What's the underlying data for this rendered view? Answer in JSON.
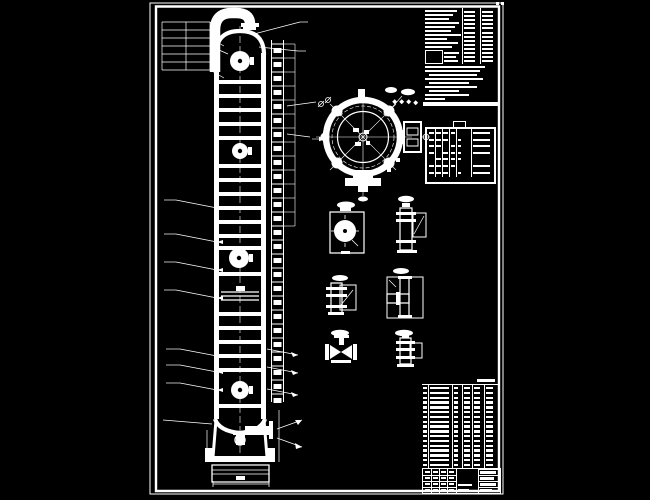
{
  "app": {
    "background": "#000000",
    "ink": "#ffffff",
    "sheet_visible_text_legible": false
  },
  "tower_elevation": {
    "tray_band_ys": [
      80,
      94,
      108,
      122,
      136,
      164,
      178,
      192,
      206,
      220,
      234,
      246,
      272,
      312,
      326,
      340,
      354,
      368,
      404
    ],
    "tray_x": 219,
    "tray_w": 42,
    "tray_h": 4,
    "manholes": [
      [
        240,
        61,
        10
      ],
      [
        240,
        151,
        8
      ],
      [
        239,
        258,
        10
      ],
      [
        240,
        390,
        9
      ]
    ],
    "feed_line_ys": [
      292,
      296,
      300
    ],
    "ladder": {
      "x1": 271.5,
      "x2": 283.5,
      "y0": 44,
      "y1": 398,
      "pitch": 14
    },
    "dim_ties": {
      "x0": 284,
      "x1": 295,
      "y0": 44,
      "y1": 226,
      "pitch": 14
    }
  },
  "dimension_leaders": {
    "top_left_stack_ys": [
      22,
      30,
      38,
      46,
      54,
      62,
      70
    ],
    "top_left_stack_x": [
      162,
      210
    ],
    "mid_left_ys": [
      208,
      242,
      270,
      298
    ],
    "low_left_ys": [
      356,
      372,
      390
    ],
    "right_lower_ys": [
      349,
      367,
      389
    ]
  },
  "tech_notes_panel": {
    "x": 423,
    "y": 8,
    "w": 74,
    "h": 94,
    "upper_lines": [
      [
        2,
        2,
        32
      ],
      [
        2,
        6,
        28
      ],
      [
        2,
        10,
        24
      ],
      [
        2,
        14,
        34
      ],
      [
        2,
        18,
        30
      ],
      [
        2,
        22,
        26
      ],
      [
        2,
        26,
        36
      ],
      [
        2,
        30,
        22
      ],
      [
        2,
        34,
        33
      ],
      [
        2,
        38,
        27
      ]
    ],
    "box": [
      2,
      42,
      16,
      12
    ],
    "box_side_lines": [
      [
        21,
        44,
        15
      ],
      [
        21,
        48,
        12
      ],
      [
        21,
        52,
        14
      ]
    ],
    "table": {
      "rows": 13,
      "col_x": [
        41,
        59
      ],
      "bar_w": 11,
      "row_h": 4.1,
      "y0": 3,
      "divider_x": [
        38.5,
        56.5
      ],
      "divider_h": 56
    },
    "note_lines": [
      [
        2,
        58,
        60
      ],
      [
        2,
        62,
        55
      ],
      [
        6,
        66,
        48
      ],
      [
        2,
        70,
        58
      ],
      [
        6,
        74,
        40
      ],
      [
        2,
        78,
        52
      ],
      [
        6,
        82,
        30
      ],
      [
        2,
        86,
        44
      ],
      [
        2,
        90,
        20
      ]
    ],
    "bottom_band": [
      0,
      93.5,
      77,
      4
    ]
  },
  "nozzle_table": {
    "x": 425,
    "y": 127,
    "w": 67,
    "h": 53,
    "tab": [
      26,
      -6,
      11,
      6
    ],
    "rows": 7,
    "row_h": 6.6,
    "y0": 3,
    "dash_cols": [
      [
        2,
        5
      ],
      [
        9,
        5
      ],
      [
        16,
        5
      ],
      [
        24,
        4
      ],
      [
        31,
        3
      ],
      [
        46,
        17
      ]
    ],
    "divider_x": [
      7.5,
      14.5,
      22,
      29,
      44
    ]
  },
  "parts_list": {
    "x": 422,
    "y": 384,
    "w": 76,
    "h": 84,
    "rows": 17,
    "row_h": 4.8,
    "y0": 2,
    "dash_cols": [
      [
        1,
        4
      ],
      [
        8,
        20
      ],
      [
        32,
        6
      ],
      [
        42,
        6
      ],
      [
        52,
        7
      ],
      [
        64,
        9
      ]
    ],
    "divider_x": [
      6,
      30,
      40,
      50,
      62
    ],
    "top_tag": [
      55,
      -4,
      18,
      3
    ]
  },
  "title_block": {
    "x": 422,
    "y": 468,
    "w": 77,
    "h": 24,
    "row_ys": [
      6,
      12,
      18
    ],
    "left_col_x": [
      8,
      16,
      24,
      33
    ],
    "mid_cell_x": [
      33,
      55
    ],
    "mid_bars": [
      [
        35,
        15,
        14
      ],
      [
        35,
        20,
        11
      ]
    ],
    "right_col_x": 55,
    "right_bars_w": [
      16,
      14,
      16,
      12
    ]
  }
}
